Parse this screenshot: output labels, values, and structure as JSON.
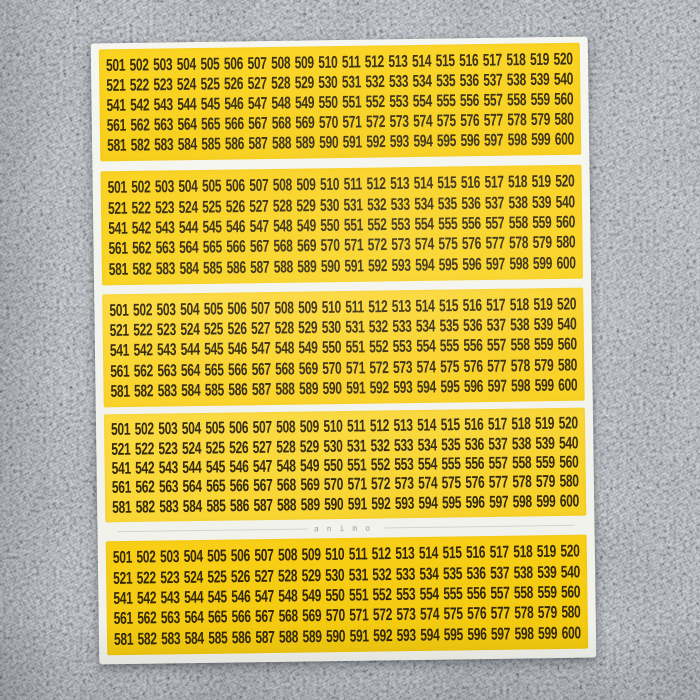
{
  "sheet": {
    "brand": "animo",
    "panels": [
      {
        "rows": [
          "501 502 503 504 505 506 507 508 509 510 511 512 513 514 515 516 517 518 519 520",
          "521 522 523 524 525 526 527 528 529 530 531 532 533 534 535 536 537 538 539 540",
          "541 542 543 544 545 546 547 548 549 550 551 552 553 554 555 556 557 558 559 560",
          "561 562 563 564 565 566 567 568 569 570 571 572 573 574 575 576 577 578 579 580",
          "581 582 583 584 585 586 587 588 589 590 591 592 593 594 595 596 597 598 599 600"
        ]
      },
      {
        "rows": [
          "501 502 503 504 505 506 507 508 509 510 511 512 513 514 515 516 517 518 519 520",
          "521 522 523 524 525 526 527 528 529 530 531 532 533 534 535 536 537 538 539 540",
          "541 542 543 544 545 546 547 548 549 550 551 552 553 554 555 556 557 558 559 560",
          "561 562 563 564 565 566 567 568 569 570 571 572 573 574 575 576 577 578 579 580",
          "581 582 583 584 585 586 587 588 589 590 591 592 593 594 595 596 597 598 599 600"
        ]
      },
      {
        "rows": [
          "501 502 503 504 505 506 507 508 509 510 511 512 513 514 515 516 517 518 519 520",
          "521 522 523 524 525 526 527 528 529 530 531 532 533 534 535 536 537 538 539 540",
          "541 542 543 544 545 546 547 548 549 550 551 552 553 554 555 556 557 558 559 560",
          "561 562 563 564 565 566 567 568 569 570 571 572 573 574 575 576 577 578 579 580",
          "581 582 583 584 585 586 587 588 589 590 591 592 593 594 595 596 597 598 599 600"
        ]
      },
      {
        "rows": [
          "501 502 503 504 505 506 507 508 509 510 511 512 513 514 515 516 517 518 519 520",
          "521 522 523 524 525 526 527 528 529 530 531 532 533 534 535 536 537 538 539 540",
          "541 542 543 544 545 546 547 548 549 550 551 552 553 554 555 556 557 558 559 560",
          "561 562 563 564 565 566 567 568 569 570 571 572 573 574 575 576 577 578 579 580",
          "581 582 583 584 585 586 587 588 589 590 591 592 593 594 595 596 597 598 599 600"
        ]
      },
      {
        "rows": [
          "501 502 503 504 505 506 507 508 509 510 511 512 513 514 515 516 517 518 519 520",
          "521 522 523 524 525 526 527 528 529 530 531 532 533 534 535 536 537 538 539 540",
          "541 542 543 544 545 546 547 548 549 550 551 552 553 554 555 556 557 558 559 560",
          "561 562 563 564 565 566 567 568 569 570 571 572 573 574 575 576 577 578 579 580",
          "581 582 583 584 585 586 587 588 589 590 591 592 593 594 595 596 597 598 599 600"
        ]
      }
    ]
  },
  "colors": {
    "sticker_yellow": "#F9D21A",
    "number_text": "#33280B",
    "backing_white": "#F4F4EE",
    "fabric_gray": "#A7ADB3",
    "brand_gray": "#A2A29C"
  }
}
